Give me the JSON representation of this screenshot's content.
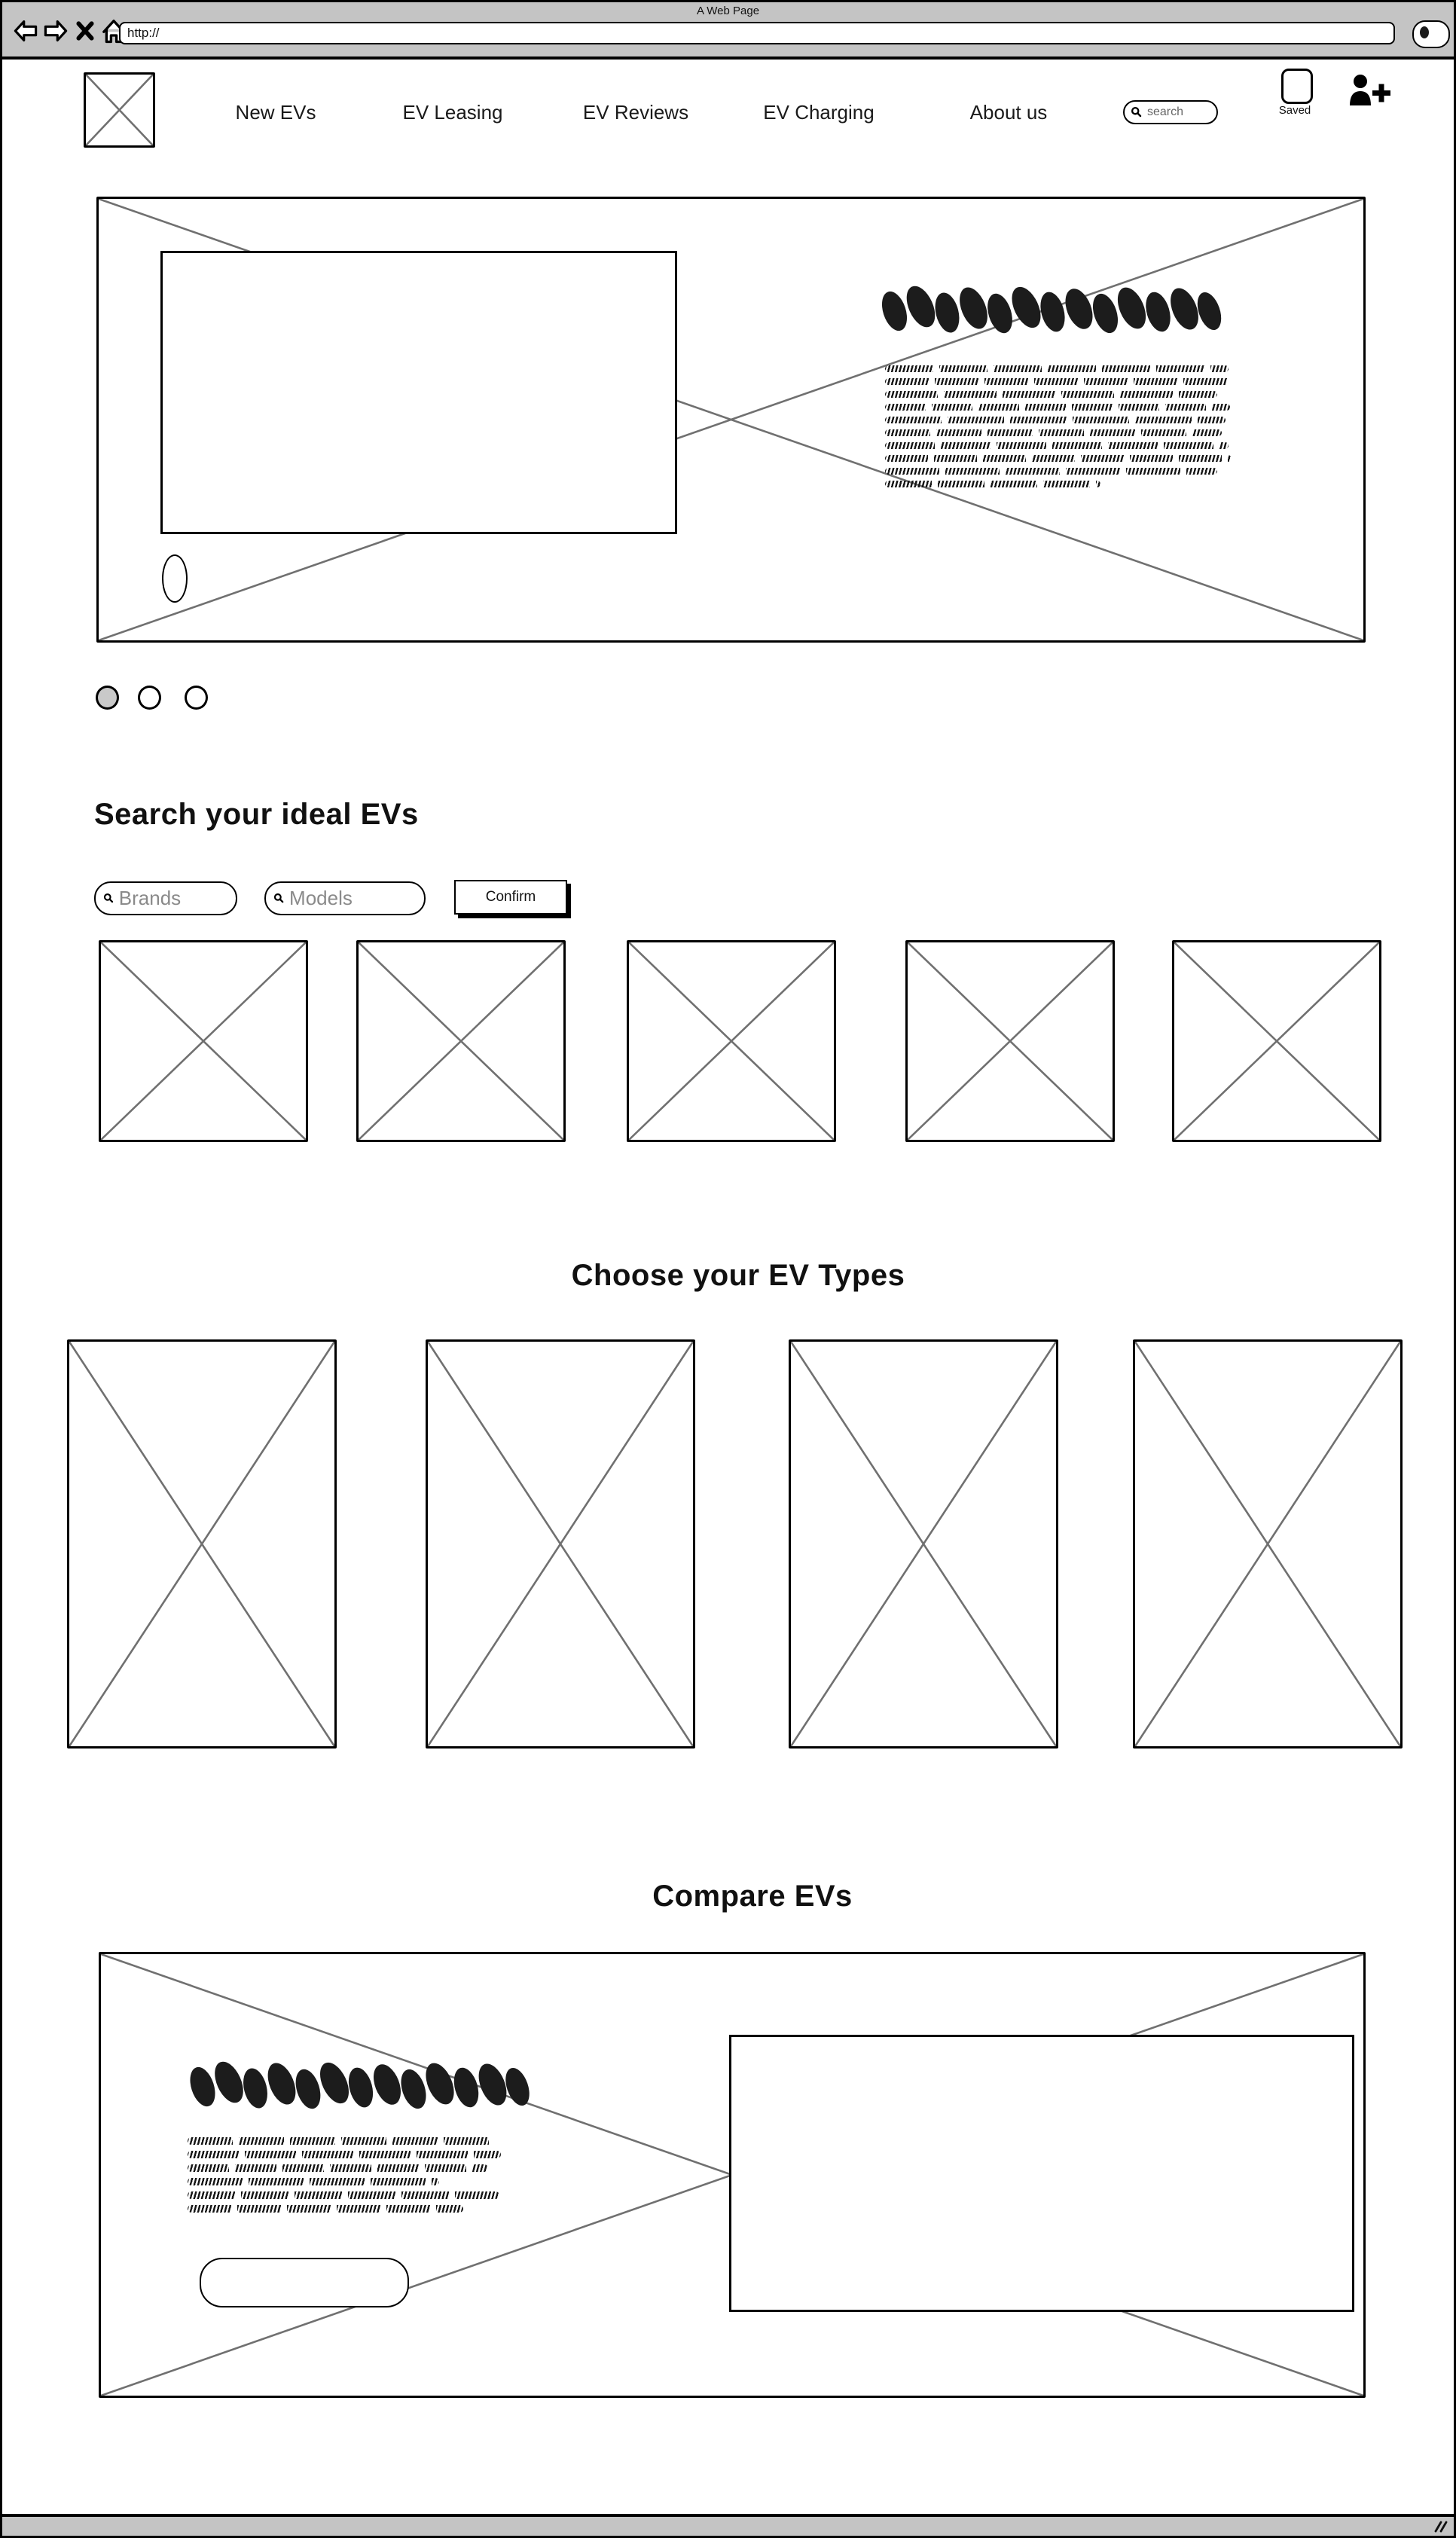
{
  "browser": {
    "window_title": "A Web Page",
    "url_value": "http://",
    "toolbar_icons": [
      "back-arrow",
      "forward-arrow",
      "close",
      "home"
    ],
    "search_button_icon": "magnifier"
  },
  "nav": {
    "logo_icon": "image-placeholder",
    "items": [
      {
        "label": "New EVs"
      },
      {
        "label": "EV Leasing"
      },
      {
        "label": "EV Reviews"
      },
      {
        "label": "EV Charging"
      },
      {
        "label": "About us"
      }
    ],
    "search": {
      "placeholder": "search",
      "icon": "magnifier"
    },
    "saved": {
      "label": "Saved",
      "icon": "saved-slot"
    },
    "add_user_icon": "add-user"
  },
  "hero": {
    "content": [
      "image-placeholder",
      "inner-image-frame",
      "scribble-heading",
      "scribble-paragraph",
      "oval-marker"
    ],
    "carousel": {
      "dot_count": 3,
      "active_dot_index": 0
    }
  },
  "search_section": {
    "heading": "Search your ideal EVs",
    "brands_placeholder": "Brands",
    "models_placeholder": "Models",
    "confirm_label": "Confirm",
    "result_placeholder_count": 5
  },
  "types_section": {
    "heading": "Choose your EV Types",
    "type_placeholder_count": 4
  },
  "compare_section": {
    "heading": "Compare EVs",
    "content": [
      "image-placeholder",
      "scribble-heading",
      "scribble-paragraph",
      "rounded-button",
      "inner-image-frame"
    ]
  },
  "colors": {
    "chrome_gray": "#c4c4c4",
    "placeholder_line_gray": "#707070",
    "dot_active_fill": "#c9c9c9",
    "scribble_ink": "#1c1c1c",
    "placeholder_text_gray": "#8a8a8a"
  }
}
